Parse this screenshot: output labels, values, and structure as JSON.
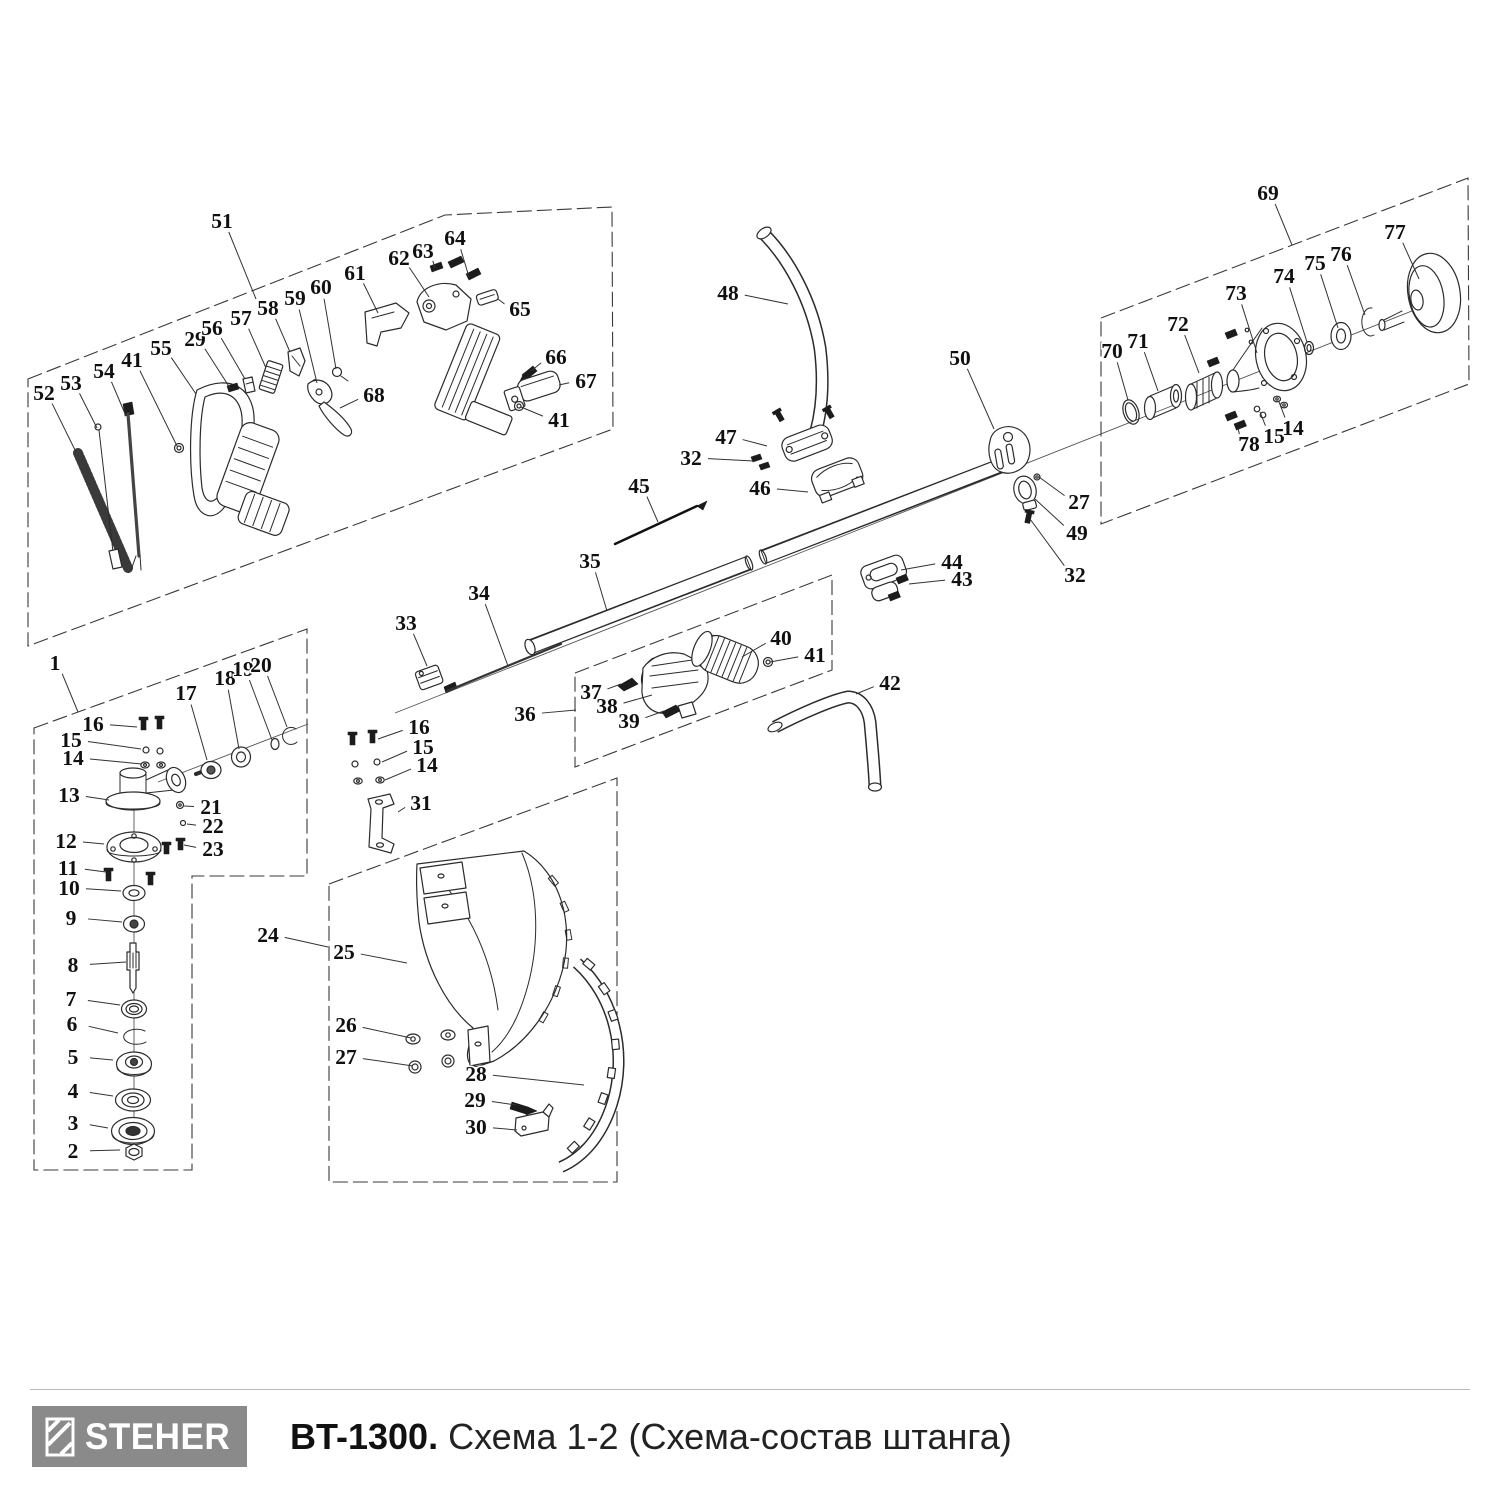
{
  "footer": {
    "brand": "STEHER",
    "model": "BT-1300.",
    "schema": "Схема 1-2 (Схема-состав штанга)",
    "logo_bg": "#8a8a8a"
  },
  "diagram": {
    "callouts": [
      {
        "n": "51",
        "x": 222,
        "y": 221,
        "ex": 256,
        "ey": 299
      },
      {
        "n": "52",
        "x": 44,
        "y": 393,
        "ex": 76,
        "ey": 452
      },
      {
        "n": "53",
        "x": 71,
        "y": 383,
        "ex": 97,
        "ey": 428
      },
      {
        "n": "54",
        "x": 104,
        "y": 371,
        "ex": 126,
        "ey": 416
      },
      {
        "n": "41",
        "x": 132,
        "y": 360,
        "ex": 177,
        "ey": 446
      },
      {
        "n": "55",
        "x": 161,
        "y": 348,
        "ex": 196,
        "ey": 394
      },
      {
        "n": "29",
        "x": 195,
        "y": 339,
        "ex": 230,
        "ey": 388
      },
      {
        "n": "56",
        "x": 212,
        "y": 328,
        "ex": 245,
        "ey": 379
      },
      {
        "n": "57",
        "x": 241,
        "y": 318,
        "ex": 266,
        "ey": 368
      },
      {
        "n": "58",
        "x": 268,
        "y": 308,
        "ex": 290,
        "ey": 352
      },
      {
        "n": "59",
        "x": 295,
        "y": 298,
        "ex": 317,
        "ey": 383
      },
      {
        "n": "60",
        "x": 321,
        "y": 287,
        "ex": 336,
        "ey": 369
      },
      {
        "n": "61",
        "x": 355,
        "y": 273,
        "ex": 378,
        "ey": 313
      },
      {
        "n": "62",
        "x": 399,
        "y": 258,
        "ex": 429,
        "ey": 297
      },
      {
        "n": "63",
        "x": 423,
        "y": 251,
        "ex": 435,
        "ey": 268
      },
      {
        "n": "64",
        "x": 455,
        "y": 238,
        "ex": 469,
        "ey": 277
      },
      {
        "n": "65",
        "x": 520,
        "y": 309,
        "ex": 498,
        "ey": 299
      },
      {
        "n": "66",
        "x": 556,
        "y": 357,
        "ex": 531,
        "ey": 371
      },
      {
        "n": "67",
        "x": 586,
        "y": 381,
        "ex": 559,
        "ey": 385
      },
      {
        "n": "68",
        "x": 374,
        "y": 395,
        "ex": 340,
        "ey": 408
      },
      {
        "n": "41",
        "x": 559,
        "y": 420,
        "ex": 521,
        "ey": 407
      },
      {
        "n": "1",
        "x": 55,
        "y": 663,
        "ex": 78,
        "ey": 712
      },
      {
        "n": "16",
        "x": 93,
        "y": 724,
        "ex": 137,
        "ey": 727
      },
      {
        "n": "15",
        "x": 71,
        "y": 740,
        "ex": 141,
        "ey": 749
      },
      {
        "n": "14",
        "x": 73,
        "y": 758,
        "ex": 142,
        "ey": 764
      },
      {
        "n": "13",
        "x": 69,
        "y": 795,
        "ex": 109,
        "ey": 800
      },
      {
        "n": "17",
        "x": 186,
        "y": 693,
        "ex": 207,
        "ey": 760
      },
      {
        "n": "18",
        "x": 225,
        "y": 678,
        "ex": 239,
        "ey": 749
      },
      {
        "n": "19",
        "x": 243,
        "y": 669,
        "ex": 272,
        "ey": 740
      },
      {
        "n": "20",
        "x": 261,
        "y": 665,
        "ex": 287,
        "ey": 727
      },
      {
        "n": "21",
        "x": 211,
        "y": 807,
        "ex": 184,
        "ey": 806
      },
      {
        "n": "22",
        "x": 213,
        "y": 826,
        "ex": 187,
        "ey": 824
      },
      {
        "n": "23",
        "x": 213,
        "y": 849,
        "ex": 184,
        "ey": 845
      },
      {
        "n": "12",
        "x": 66,
        "y": 841,
        "ex": 104,
        "ey": 844
      },
      {
        "n": "11",
        "x": 68,
        "y": 868,
        "ex": 106,
        "ey": 872
      },
      {
        "n": "10",
        "x": 69,
        "y": 888,
        "ex": 121,
        "ey": 891
      },
      {
        "n": "9",
        "x": 71,
        "y": 918,
        "ex": 122,
        "ey": 922
      },
      {
        "n": "8",
        "x": 73,
        "y": 965,
        "ex": 126,
        "ey": 962
      },
      {
        "n": "7",
        "x": 71,
        "y": 999,
        "ex": 120,
        "ey": 1005
      },
      {
        "n": "6",
        "x": 72,
        "y": 1024,
        "ex": 118,
        "ey": 1033
      },
      {
        "n": "5",
        "x": 73,
        "y": 1057,
        "ex": 113,
        "ey": 1060
      },
      {
        "n": "4",
        "x": 73,
        "y": 1091,
        "ex": 113,
        "ey": 1096
      },
      {
        "n": "3",
        "x": 73,
        "y": 1123,
        "ex": 108,
        "ey": 1128
      },
      {
        "n": "2",
        "x": 73,
        "y": 1151,
        "ex": 120,
        "ey": 1150
      },
      {
        "n": "24",
        "x": 268,
        "y": 935,
        "ex": 328,
        "ey": 947
      },
      {
        "n": "16",
        "x": 419,
        "y": 727,
        "ex": 378,
        "ey": 739
      },
      {
        "n": "15",
        "x": 423,
        "y": 747,
        "ex": 382,
        "ey": 762
      },
      {
        "n": "14",
        "x": 427,
        "y": 765,
        "ex": 385,
        "ey": 780
      },
      {
        "n": "31",
        "x": 421,
        "y": 803,
        "ex": 398,
        "ey": 812
      },
      {
        "n": "33",
        "x": 406,
        "y": 623,
        "ex": 427,
        "ey": 666
      },
      {
        "n": "34",
        "x": 479,
        "y": 593,
        "ex": 508,
        "ey": 666
      },
      {
        "n": "35",
        "x": 590,
        "y": 561,
        "ex": 607,
        "ey": 611
      },
      {
        "n": "45",
        "x": 639,
        "y": 486,
        "ex": 658,
        "ey": 522
      },
      {
        "n": "46",
        "x": 760,
        "y": 488,
        "ex": 808,
        "ey": 492
      },
      {
        "n": "47",
        "x": 726,
        "y": 437,
        "ex": 767,
        "ey": 446
      },
      {
        "n": "32",
        "x": 691,
        "y": 458,
        "ex": 754,
        "ey": 461
      },
      {
        "n": "48",
        "x": 728,
        "y": 293,
        "ex": 788,
        "ey": 304
      },
      {
        "n": "50",
        "x": 960,
        "y": 358,
        "ex": 994,
        "ey": 429
      },
      {
        "n": "27",
        "x": 1079,
        "y": 502,
        "ex": 1039,
        "ey": 477
      },
      {
        "n": "49",
        "x": 1077,
        "y": 533,
        "ex": 1035,
        "ey": 499
      },
      {
        "n": "32",
        "x": 1075,
        "y": 575,
        "ex": 1030,
        "ey": 519
      },
      {
        "n": "44",
        "x": 952,
        "y": 562,
        "ex": 901,
        "ey": 570
      },
      {
        "n": "43",
        "x": 962,
        "y": 579,
        "ex": 909,
        "ey": 584
      },
      {
        "n": "36",
        "x": 525,
        "y": 714,
        "ex": 576,
        "ey": 710
      },
      {
        "n": "37",
        "x": 591,
        "y": 692,
        "ex": 621,
        "ey": 684
      },
      {
        "n": "38",
        "x": 607,
        "y": 706,
        "ex": 652,
        "ey": 695
      },
      {
        "n": "39",
        "x": 629,
        "y": 721,
        "ex": 664,
        "ey": 711
      },
      {
        "n": "40",
        "x": 781,
        "y": 638,
        "ex": 742,
        "ey": 657
      },
      {
        "n": "41",
        "x": 815,
        "y": 655,
        "ex": 770,
        "ey": 662
      },
      {
        "n": "42",
        "x": 890,
        "y": 683,
        "ex": 856,
        "ey": 694
      },
      {
        "n": "25",
        "x": 344,
        "y": 952,
        "ex": 407,
        "ey": 963
      },
      {
        "n": "26",
        "x": 346,
        "y": 1025,
        "ex": 411,
        "ey": 1038
      },
      {
        "n": "27",
        "x": 346,
        "y": 1057,
        "ex": 413,
        "ey": 1066
      },
      {
        "n": "28",
        "x": 476,
        "y": 1074,
        "ex": 584,
        "ey": 1085
      },
      {
        "n": "29",
        "x": 475,
        "y": 1100,
        "ex": 516,
        "ey": 1105
      },
      {
        "n": "30",
        "x": 476,
        "y": 1127,
        "ex": 517,
        "ey": 1130
      },
      {
        "n": "69",
        "x": 1268,
        "y": 193,
        "ex": 1292,
        "ey": 245
      },
      {
        "n": "70",
        "x": 1112,
        "y": 351,
        "ex": 1128,
        "ey": 400
      },
      {
        "n": "71",
        "x": 1138,
        "y": 341,
        "ex": 1158,
        "ey": 391
      },
      {
        "n": "72",
        "x": 1178,
        "y": 324,
        "ex": 1199,
        "ey": 373
      },
      {
        "n": "73",
        "x": 1236,
        "y": 293,
        "ex": 1257,
        "ey": 353
      },
      {
        "n": "74",
        "x": 1284,
        "y": 276,
        "ex": 1307,
        "ey": 342
      },
      {
        "n": "75",
        "x": 1315,
        "y": 263,
        "ex": 1338,
        "ey": 328
      },
      {
        "n": "76",
        "x": 1341,
        "y": 254,
        "ex": 1365,
        "ey": 315
      },
      {
        "n": "77",
        "x": 1395,
        "y": 232,
        "ex": 1419,
        "ey": 279
      },
      {
        "n": "78",
        "x": 1249,
        "y": 444,
        "ex": 1238,
        "ey": 428
      },
      {
        "n": "15",
        "x": 1274,
        "y": 436,
        "ex": 1260,
        "ey": 412
      },
      {
        "n": "14",
        "x": 1293,
        "y": 428,
        "ex": 1279,
        "ey": 402
      }
    ]
  }
}
